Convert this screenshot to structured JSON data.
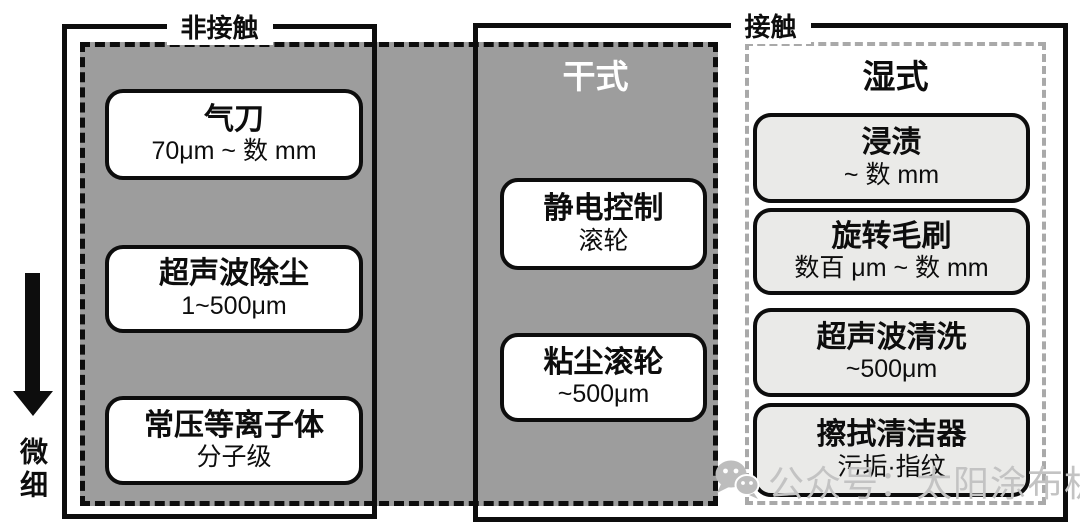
{
  "diagram": {
    "top_labels": {
      "non_contact": "非接触",
      "contact": "接触"
    },
    "regions": {
      "dry": {
        "label": "干式",
        "fill_color": "#9d9d9d",
        "border_style": "dashed-black"
      },
      "wet": {
        "label": "湿式",
        "fill_color": "#ffffff",
        "border_color": "#a9a9a9",
        "border_style": "dashed-gray"
      }
    },
    "axis": {
      "label": "微细",
      "direction": "down"
    },
    "methods": {
      "dry_noncontact": [
        {
          "name": "气刀",
          "range": "70μm ~ 数 mm"
        },
        {
          "name": "超声波除尘",
          "range": "1~500μm"
        },
        {
          "name": "常压等离子体",
          "range": "分子级"
        }
      ],
      "dry_contact": [
        {
          "name": "静电控制",
          "range": "滚轮"
        },
        {
          "name": "粘尘滚轮",
          "range": "~500μm"
        }
      ],
      "wet_contact": [
        {
          "name": "浸渍",
          "range": "~ 数 mm"
        },
        {
          "name": "旋转毛刷",
          "range": "数百 μm ~ 数 mm"
        },
        {
          "name": "超声波清洗",
          "range": "~500μm"
        },
        {
          "name": "擦拭清洁器",
          "range": "污垢·指纹"
        }
      ]
    },
    "watermark": {
      "icon": "wechat-bubbles-icon",
      "text": "公众号：太阳涂布机",
      "color": "#c3c3c3"
    },
    "colors": {
      "outline": "#0d0d0d",
      "dry_fill": "#9d9d9d",
      "wet_method_fill": "#eaeae8",
      "dry_title_text": "#ffffff"
    }
  }
}
